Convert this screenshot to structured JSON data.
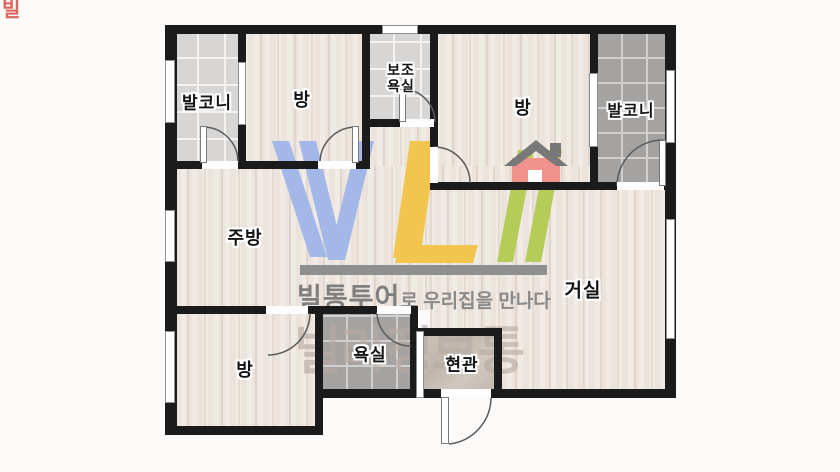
{
  "page": {
    "background": "#fbfaf9"
  },
  "floorplan": {
    "rooms": {
      "balcony_left": {
        "label": "발코니"
      },
      "bedroom_top_left": {
        "label": "방"
      },
      "aux_bathroom": {
        "label_line1": "보조",
        "label_line2": "욕실"
      },
      "bedroom_top_right": {
        "label": "방"
      },
      "balcony_right": {
        "label": "발코니"
      },
      "kitchen": {
        "label": "주방"
      },
      "living_room": {
        "label": "거실"
      },
      "bedroom_bottom": {
        "label": "방"
      },
      "bathroom": {
        "label": "욕실"
      },
      "entrance": {
        "label": "현관"
      }
    }
  },
  "watermark": {
    "tagline_brand": "빌통투어",
    "tagline_rest": "로 우리집을 만나다",
    "brand_text": "빌라정보통",
    "corner_mark": "빌",
    "colors": {
      "v_blue": "#a3b7e8",
      "l_yellow": "#f2c64e",
      "slash_green": "#b5cd58",
      "bar_gray": "#8f8f8f",
      "tagline_gray": "#7f7f7f",
      "brand_gray": "#c0b4ae",
      "house_body": "#f0938d",
      "house_roof": "#787878",
      "house_door": "#ffffff"
    }
  }
}
